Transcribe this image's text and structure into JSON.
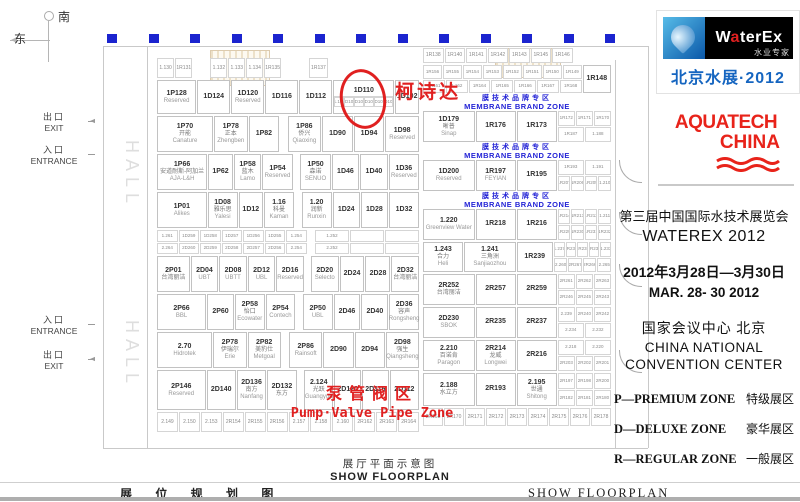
{
  "compass": {
    "south": "南",
    "east": "东"
  },
  "entrances": [
    {
      "cn": "出口",
      "en": "EXIT",
      "dir": "left",
      "y": 110
    },
    {
      "cn": "入口",
      "en": "ENTRANCE",
      "dir": "right",
      "y": 143
    },
    {
      "cn": "入口",
      "en": "ENTRANCE",
      "dir": "right",
      "y": 313
    },
    {
      "cn": "出口",
      "en": "EXIT",
      "dir": "left",
      "y": 348
    }
  ],
  "annotations": {
    "circled_booth": "1D110",
    "circle_label": "柯诗达",
    "pump_zone_cn": "泵管阀区",
    "pump_zone_en": "Pump·Valve Pipe Zone"
  },
  "caption": {
    "cn": "展厅平面示意图",
    "en": "SHOW  FLOORPLAN"
  },
  "bottom_bar": {
    "left_cn": "展 位 规 划 图",
    "right_en": "SHOW  FLOORPLAN"
  },
  "colors": {
    "marker_blue": "#1b24cf",
    "zone_blue": "#2323d6",
    "annotation_red": "#e02020",
    "waterex_blue": "#1565c0",
    "aquatech_red": "#e8231a"
  },
  "sidebar": {
    "waterex": {
      "wordmark_w": "W",
      "wordmark_a": "a",
      "wordmark_rest": "terEx",
      "tagline": "水业专家",
      "event": "北京水展·2012"
    },
    "aquatech": {
      "line1": "AQUATECH",
      "line2": "CHINA"
    },
    "title_cn": "第三届中国国际水技术展览会",
    "title_en": "WATEREX 2012",
    "date_cn": "2012年3月28日—3月30日",
    "date_en": "MAR. 28- 30  2012",
    "venue_cn": "国家会议中心    北京",
    "venue_en1": "CHINA NATIONAL",
    "venue_en2": "CONVENTION CENTER",
    "legend": [
      {
        "en": "P—PREMIUM ZONE",
        "cn": "特级展区"
      },
      {
        "en": "D—DELUXE ZONE",
        "cn": "豪华展区"
      },
      {
        "en": "R—REGULAR ZONE",
        "cn": "一般展区"
      }
    ]
  },
  "floorplan": {
    "hall_label": "HALL",
    "top_markers": 13,
    "zone": {
      "cn": "膜技术品牌专区",
      "en": "MEMBRANE  BRAND ZONE"
    },
    "left_rows": [
      {
        "h": 20,
        "cells": [
          {
            "t": "sm1",
            "ids": [
              "1.130",
              "1R131"
            ],
            "w": 1.1
          },
          {
            "t": "gap",
            "w": 0.5
          },
          {
            "t": "sm1",
            "ids": [
              "1.132",
              "1.133",
              "1.134",
              "1R135"
            ],
            "w": 2.2
          },
          {
            "t": "gap",
            "w": 0.8
          },
          {
            "t": "sm1",
            "ids": [
              "1R137"
            ],
            "w": 0.6
          },
          {
            "t": "gap",
            "w": 2.8
          }
        ]
      },
      {
        "h": 34,
        "cells": [
          {
            "t": "b",
            "id": "1P128",
            "en": "Reserved",
            "w": 1.2
          },
          {
            "t": "b",
            "id": "1D124",
            "w": 1
          },
          {
            "t": "b",
            "id": "1D120",
            "en": "Reserved",
            "w": 1
          },
          {
            "t": "b",
            "id": "1D116",
            "w": 1
          },
          {
            "t": "b",
            "id": "1D112",
            "w": 1
          },
          {
            "t": "b",
            "id": "1D110",
            "w": 1.9,
            "circle": true,
            "sub": [
              "1.109",
              "1D108",
              "1D107",
              "1D106",
              "1D105",
              "1D104"
            ]
          },
          {
            "t": "b",
            "id": "1D102",
            "w": 0.7
          }
        ]
      },
      {
        "h": 36,
        "cells": [
          {
            "t": "b",
            "id": "1P70",
            "cn": "开能",
            "en": "Canature",
            "w": 1.7
          },
          {
            "t": "b",
            "id": "1P78",
            "cn": "正本",
            "en": "Zhengben",
            "w": 1
          },
          {
            "t": "b",
            "id": "1P82",
            "w": 0.9
          },
          {
            "t": "gap",
            "w": 0.2
          },
          {
            "t": "b",
            "id": "1P86",
            "cn": "侨兴",
            "en": "Qiaoxing",
            "w": 1
          },
          {
            "t": "b",
            "id": "1D90",
            "w": 0.9
          },
          {
            "t": "b",
            "id": "1D94",
            "w": 0.9
          },
          {
            "t": "b",
            "id": "1D98",
            "en": "Reserved",
            "w": 1
          }
        ]
      },
      {
        "h": 36,
        "cells": [
          {
            "t": "b",
            "id": "1P66",
            "cn": "安道耐斯-阿加兰",
            "en": "AJA-L&H",
            "w": 1.7
          },
          {
            "t": "b",
            "id": "1P62",
            "w": 0.8
          },
          {
            "t": "b",
            "id": "1P58",
            "cn": "蓝木",
            "en": "Lamo",
            "w": 0.9
          },
          {
            "t": "b",
            "id": "1P54",
            "en": "Reserved",
            "w": 1
          },
          {
            "t": "gap",
            "w": 0.2
          },
          {
            "t": "b",
            "id": "1P50",
            "cn": "森诺",
            "en": "SENUO",
            "w": 1
          },
          {
            "t": "b",
            "id": "1D46",
            "w": 0.9
          },
          {
            "t": "b",
            "id": "1D40",
            "w": 0.9
          },
          {
            "t": "b",
            "id": "1D36",
            "en": "Reserved",
            "w": 1
          }
        ]
      },
      {
        "h": 36,
        "cells": [
          {
            "t": "b",
            "id": "1P01",
            "en": "Alikes",
            "w": 1.7
          },
          {
            "t": "b",
            "id": "1D08",
            "cn": "雅乐思",
            "en": "Yalesi",
            "w": 1
          },
          {
            "t": "b",
            "id": "1D12",
            "w": 0.8
          },
          {
            "t": "b",
            "id": "1.16",
            "cn": "科曼",
            "en": "Kaman",
            "w": 1
          },
          {
            "t": "gap",
            "w": 0.2
          },
          {
            "t": "b",
            "id": "1.20",
            "cn": "润新",
            "en": "Runxin",
            "w": 1
          },
          {
            "t": "b",
            "id": "1D24",
            "w": 0.9
          },
          {
            "t": "b",
            "id": "1D28",
            "w": 0.9
          },
          {
            "t": "b",
            "id": "1D32",
            "w": 1
          }
        ]
      },
      {
        "h": 24,
        "cells": [
          {
            "t": "sm",
            "rows": [
              [
                "1.261",
                "1D259",
                "1D258",
                "1D257",
                "1D256",
                "1D255",
                "1.254"
              ],
              [
                "2.264",
                "2D260",
                "2D259",
                "2D258",
                "2D257",
                "2D256",
                "2.254"
              ]
            ],
            "w": 4.6
          },
          {
            "t": "gap",
            "w": 0.2
          },
          {
            "t": "sm",
            "rows": [
              [
                "1.252",
                "",
                ""
              ],
              [
                "2.252",
                "",
                ""
              ]
            ],
            "w": 3.2
          }
        ]
      },
      {
        "h": 36,
        "cells": [
          {
            "t": "b",
            "id": "2P01",
            "cn": "台湾丽洁",
            "w": 1.2
          },
          {
            "t": "b",
            "id": "2D04",
            "en": "UBT",
            "w": 1
          },
          {
            "t": "b",
            "id": "2D08",
            "en": "UBTT",
            "w": 1
          },
          {
            "t": "b",
            "id": "2D12",
            "en": "UBL",
            "w": 1
          },
          {
            "t": "b",
            "id": "2D16",
            "en": "Reserved",
            "w": 1
          },
          {
            "t": "gap",
            "w": 0.2
          },
          {
            "t": "b",
            "id": "2D20",
            "en": "Selecto",
            "w": 1
          },
          {
            "t": "b",
            "id": "2D24",
            "w": 0.9
          },
          {
            "t": "b",
            "id": "2D28",
            "w": 0.9
          },
          {
            "t": "b",
            "id": "2D32",
            "cn": "台湾丽洁",
            "w": 1
          }
        ]
      },
      {
        "h": 36,
        "cells": [
          {
            "t": "b",
            "id": "2P66",
            "en": "BBL",
            "w": 1.7
          },
          {
            "t": "b",
            "id": "2P60",
            "w": 0.9
          },
          {
            "t": "b",
            "id": "2P58",
            "cn": "怡口",
            "en": "Ecowater",
            "w": 1
          },
          {
            "t": "b",
            "id": "2P54",
            "en": "Contech",
            "w": 1
          },
          {
            "t": "gap",
            "w": 0.2
          },
          {
            "t": "b",
            "id": "2P50",
            "en": "UBL",
            "w": 1
          },
          {
            "t": "b",
            "id": "2D46",
            "w": 0.9
          },
          {
            "t": "b",
            "id": "2D40",
            "w": 0.9
          },
          {
            "t": "b",
            "id": "2D36",
            "cn": "容声",
            "en": "Rongsheng",
            "w": 1
          }
        ]
      },
      {
        "h": 36,
        "cells": [
          {
            "t": "b",
            "id": "2.70",
            "en": "Hidrotek",
            "w": 1.7
          },
          {
            "t": "b",
            "id": "2P78",
            "cn": "伊瑞尔",
            "en": "Erie",
            "w": 1
          },
          {
            "t": "b",
            "id": "2P82",
            "cn": "美豹仕",
            "en": "Metgoal",
            "w": 1
          },
          {
            "t": "gap",
            "w": 0.2
          },
          {
            "t": "b",
            "id": "2P86",
            "en": "Rainsoft",
            "w": 1
          },
          {
            "t": "b",
            "id": "2D90",
            "w": 0.9
          },
          {
            "t": "b",
            "id": "2D94",
            "w": 0.9
          },
          {
            "t": "b",
            "id": "2D98",
            "cn": "强生",
            "en": "Qiangsheng",
            "w": 1
          }
        ]
      },
      {
        "h": 40,
        "cells": [
          {
            "t": "b",
            "id": "2P146",
            "en": "Reserved",
            "w": 1.7
          },
          {
            "t": "b",
            "id": "2D140",
            "w": 1
          },
          {
            "t": "b",
            "id": "2D136",
            "cn": "南方",
            "en": "Nanfang",
            "w": 1
          },
          {
            "t": "b",
            "id": "2D132",
            "cn": "东方",
            "w": 1
          },
          {
            "t": "gap",
            "w": 0.2
          },
          {
            "t": "b",
            "id": "2.124",
            "cn": "光跃",
            "en": "Guangyue",
            "w": 1
          },
          {
            "t": "b",
            "id": "2D120",
            "w": 0.9
          },
          {
            "t": "b",
            "id": "2D116",
            "w": 0.9
          },
          {
            "t": "b",
            "id": "2D112",
            "w": 1
          }
        ]
      },
      {
        "h": 20,
        "cells": [
          {
            "t": "sm1",
            "ids": [
              "2.149",
              "2.150",
              "2.153",
              "2R154",
              "2R155",
              "2R156",
              "2.157",
              "2.158",
              "2.160",
              "2R162",
              "2R163",
              "2R164"
            ],
            "w": 1
          }
        ]
      }
    ],
    "right_rows": [
      {
        "h": 15,
        "cells": [
          {
            "t": "sm1",
            "ids": [
              "1R138",
              "1R140",
              "1R141",
              "1R142",
              "1R143",
              "1R145",
              "1R146"
            ],
            "w": 1
          },
          {
            "t": "gap",
            "w": 0.25
          }
        ]
      },
      {
        "h": 28,
        "cells": [
          {
            "t": "sm",
            "rows": [
              [
                "1R156",
                "1R155",
                "1R154",
                "1R153",
                "1R152",
                "1R151",
                "1R150",
                "1R149"
              ],
              [
                "1R161",
                "1.162",
                "1R164",
                "1R165",
                "1R166",
                "1R167",
                "1R168"
              ]
            ],
            "w": 4.2
          },
          {
            "t": "b",
            "id": "1R148",
            "w": 0.7
          }
        ]
      },
      {
        "zone": true,
        "h": 16
      },
      {
        "h": 31,
        "cells": [
          {
            "t": "b",
            "id": "1D179",
            "cn": "晰普",
            "en": "Sinap",
            "w": 1.3
          },
          {
            "t": "b",
            "id": "1R176",
            "w": 1
          },
          {
            "t": "b",
            "id": "1R173",
            "w": 1
          },
          {
            "t": "sm",
            "rows": [
              [
                "1R172",
                "1R171",
                "1R170"
              ],
              [
                "1R187",
                "1.188"
              ]
            ],
            "w": 1.4
          }
        ]
      },
      {
        "zone": true,
        "h": 16
      },
      {
        "h": 31,
        "cells": [
          {
            "t": "b",
            "id": "1D200",
            "en": "Reserved",
            "w": 1.3
          },
          {
            "t": "b",
            "id": "1R197",
            "en": "FEYIAN",
            "w": 1
          },
          {
            "t": "b",
            "id": "1R195",
            "w": 1
          },
          {
            "t": "sm",
            "rows": [
              [
                "1R193",
                "1.191"
              ],
              [
                "1R207",
                "1R206",
                "1R205",
                "1.210"
              ]
            ],
            "w": 1.4
          }
        ]
      },
      {
        "zone": true,
        "h": 16
      },
      {
        "h": 31,
        "cells": [
          {
            "t": "b",
            "id": "1.220",
            "en": "Greenview Water",
            "w": 1.3
          },
          {
            "t": "b",
            "id": "1R218",
            "w": 1
          },
          {
            "t": "b",
            "id": "1R216",
            "w": 1
          },
          {
            "t": "sm",
            "rows": [
              [
                "1R214",
                "1R213",
                "1R212",
                "1.211"
              ],
              [
                "1R229",
                "1R230",
                "1R231",
                "1R232"
              ]
            ],
            "w": 1.4
          }
        ]
      },
      {
        "h": 30,
        "cells": [
          {
            "t": "b",
            "id": "1.243",
            "cn": "合力",
            "en": "Heli",
            "w": 1
          },
          {
            "t": "b",
            "id": "1.241",
            "cn": "三角洲",
            "en": "Sanjiaozhou",
            "w": 1.3
          },
          {
            "t": "b",
            "id": "1R239",
            "w": 0.9
          },
          {
            "t": "sm",
            "rows": [
              [
                "1.237",
                "1R236",
                "1R235",
                "1R234",
                "1.233"
              ],
              [
                "2.260",
                "2R267",
                "2R266",
                "2.265"
              ]
            ],
            "w": 1.5
          }
        ]
      },
      {
        "h": 31,
        "cells": [
          {
            "t": "b",
            "id": "2R252",
            "cn": "台湾丽洁",
            "w": 1.3
          },
          {
            "t": "b",
            "id": "2R257",
            "w": 1
          },
          {
            "t": "b",
            "id": "2R259",
            "w": 1
          },
          {
            "t": "sm",
            "rows": [
              [
                "2R261",
                "2R262",
                "2R263"
              ],
              [
                "2R246",
                "2R245",
                "2R243"
              ]
            ],
            "w": 1.4
          }
        ]
      },
      {
        "h": 31,
        "cells": [
          {
            "t": "b",
            "id": "2D230",
            "en": "SBOK",
            "w": 1.3
          },
          {
            "t": "b",
            "id": "2R235",
            "w": 1
          },
          {
            "t": "b",
            "id": "2R237",
            "w": 1
          },
          {
            "t": "sm",
            "rows": [
              [
                "2.239",
                "2R240",
                "2R242"
              ],
              [
                "2.234",
                "2.232"
              ]
            ],
            "w": 1.4
          }
        ]
      },
      {
        "h": 31,
        "cells": [
          {
            "t": "b",
            "id": "2.210",
            "cn": "百诺肯",
            "en": "Paragon",
            "w": 1.3
          },
          {
            "t": "b",
            "id": "2R214",
            "cn": "龙威",
            "en": "Longwei",
            "w": 1
          },
          {
            "t": "b",
            "id": "2R216",
            "w": 1
          },
          {
            "t": "sm",
            "rows": [
              [
                "2.218",
                "2.220"
              ],
              [
                "2R203",
                "2R202",
                "2R201"
              ]
            ],
            "w": 1.4
          }
        ]
      },
      {
        "h": 33,
        "cells": [
          {
            "t": "b",
            "id": "2.188",
            "cn": "水立方",
            "w": 1.3
          },
          {
            "t": "b",
            "id": "2R193",
            "w": 1
          },
          {
            "t": "b",
            "id": "2.195",
            "cn": "世通",
            "en": "Shitong",
            "w": 1
          },
          {
            "t": "sm",
            "rows": [
              [
                "2R197",
                "2R198",
                "2R200"
              ],
              [
                "2R182",
                "2R181",
                "2R180"
              ]
            ],
            "w": 1.4
          }
        ]
      },
      {
        "h": 18,
        "cells": [
          {
            "t": "sm1",
            "ids": [
              "2R168",
              "2R170",
              "2R171",
              "2R172",
              "2R173",
              "2R174",
              "2R175",
              "2R176",
              "2R178"
            ],
            "w": 1
          }
        ]
      }
    ]
  }
}
